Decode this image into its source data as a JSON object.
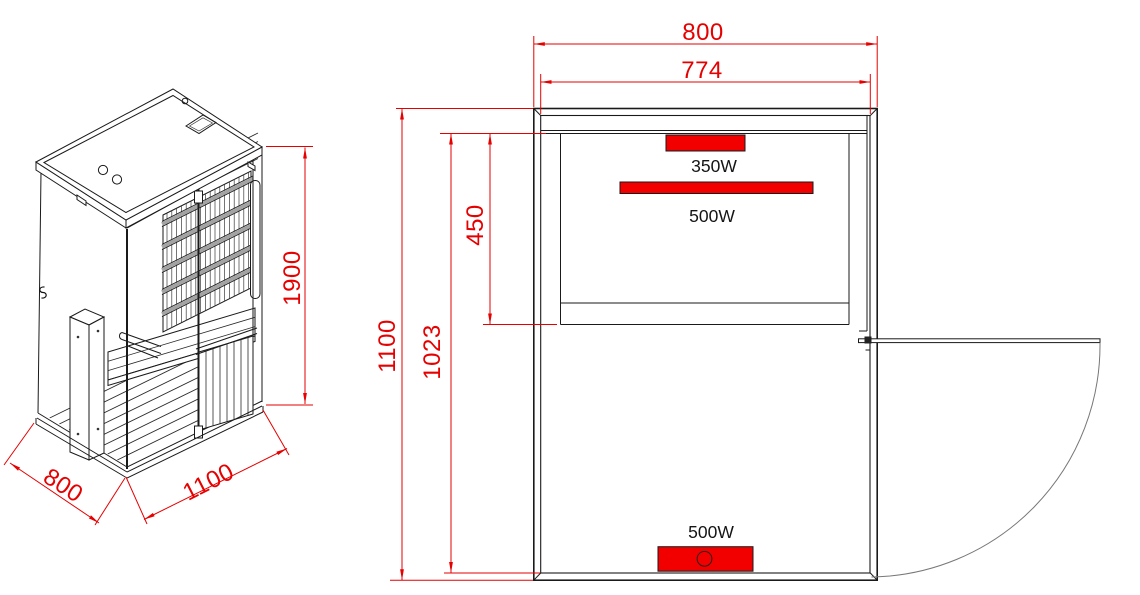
{
  "drawing": {
    "background": "#ffffff"
  },
  "colors": {
    "dimension_red": "#e60000",
    "heater_red": "#f20000",
    "line_black": "#1a1a1a",
    "rail_gray": "#a3a3a3",
    "door_arc_gray": "#777777"
  },
  "isometric_view": {
    "dim_height": "1900",
    "dim_depth": "800",
    "dim_width": "1100",
    "door_handle_marker": "S"
  },
  "plan_view": {
    "dim_outer_width": "800",
    "dim_inner_width": "774",
    "dim_outer_depth": "1100",
    "dim_inner_depth": "1023",
    "dim_bench_depth": "450",
    "heaters": {
      "back_small": {
        "label": "350W"
      },
      "back_large": {
        "label": "500W"
      },
      "front": {
        "label": "500W"
      }
    }
  }
}
